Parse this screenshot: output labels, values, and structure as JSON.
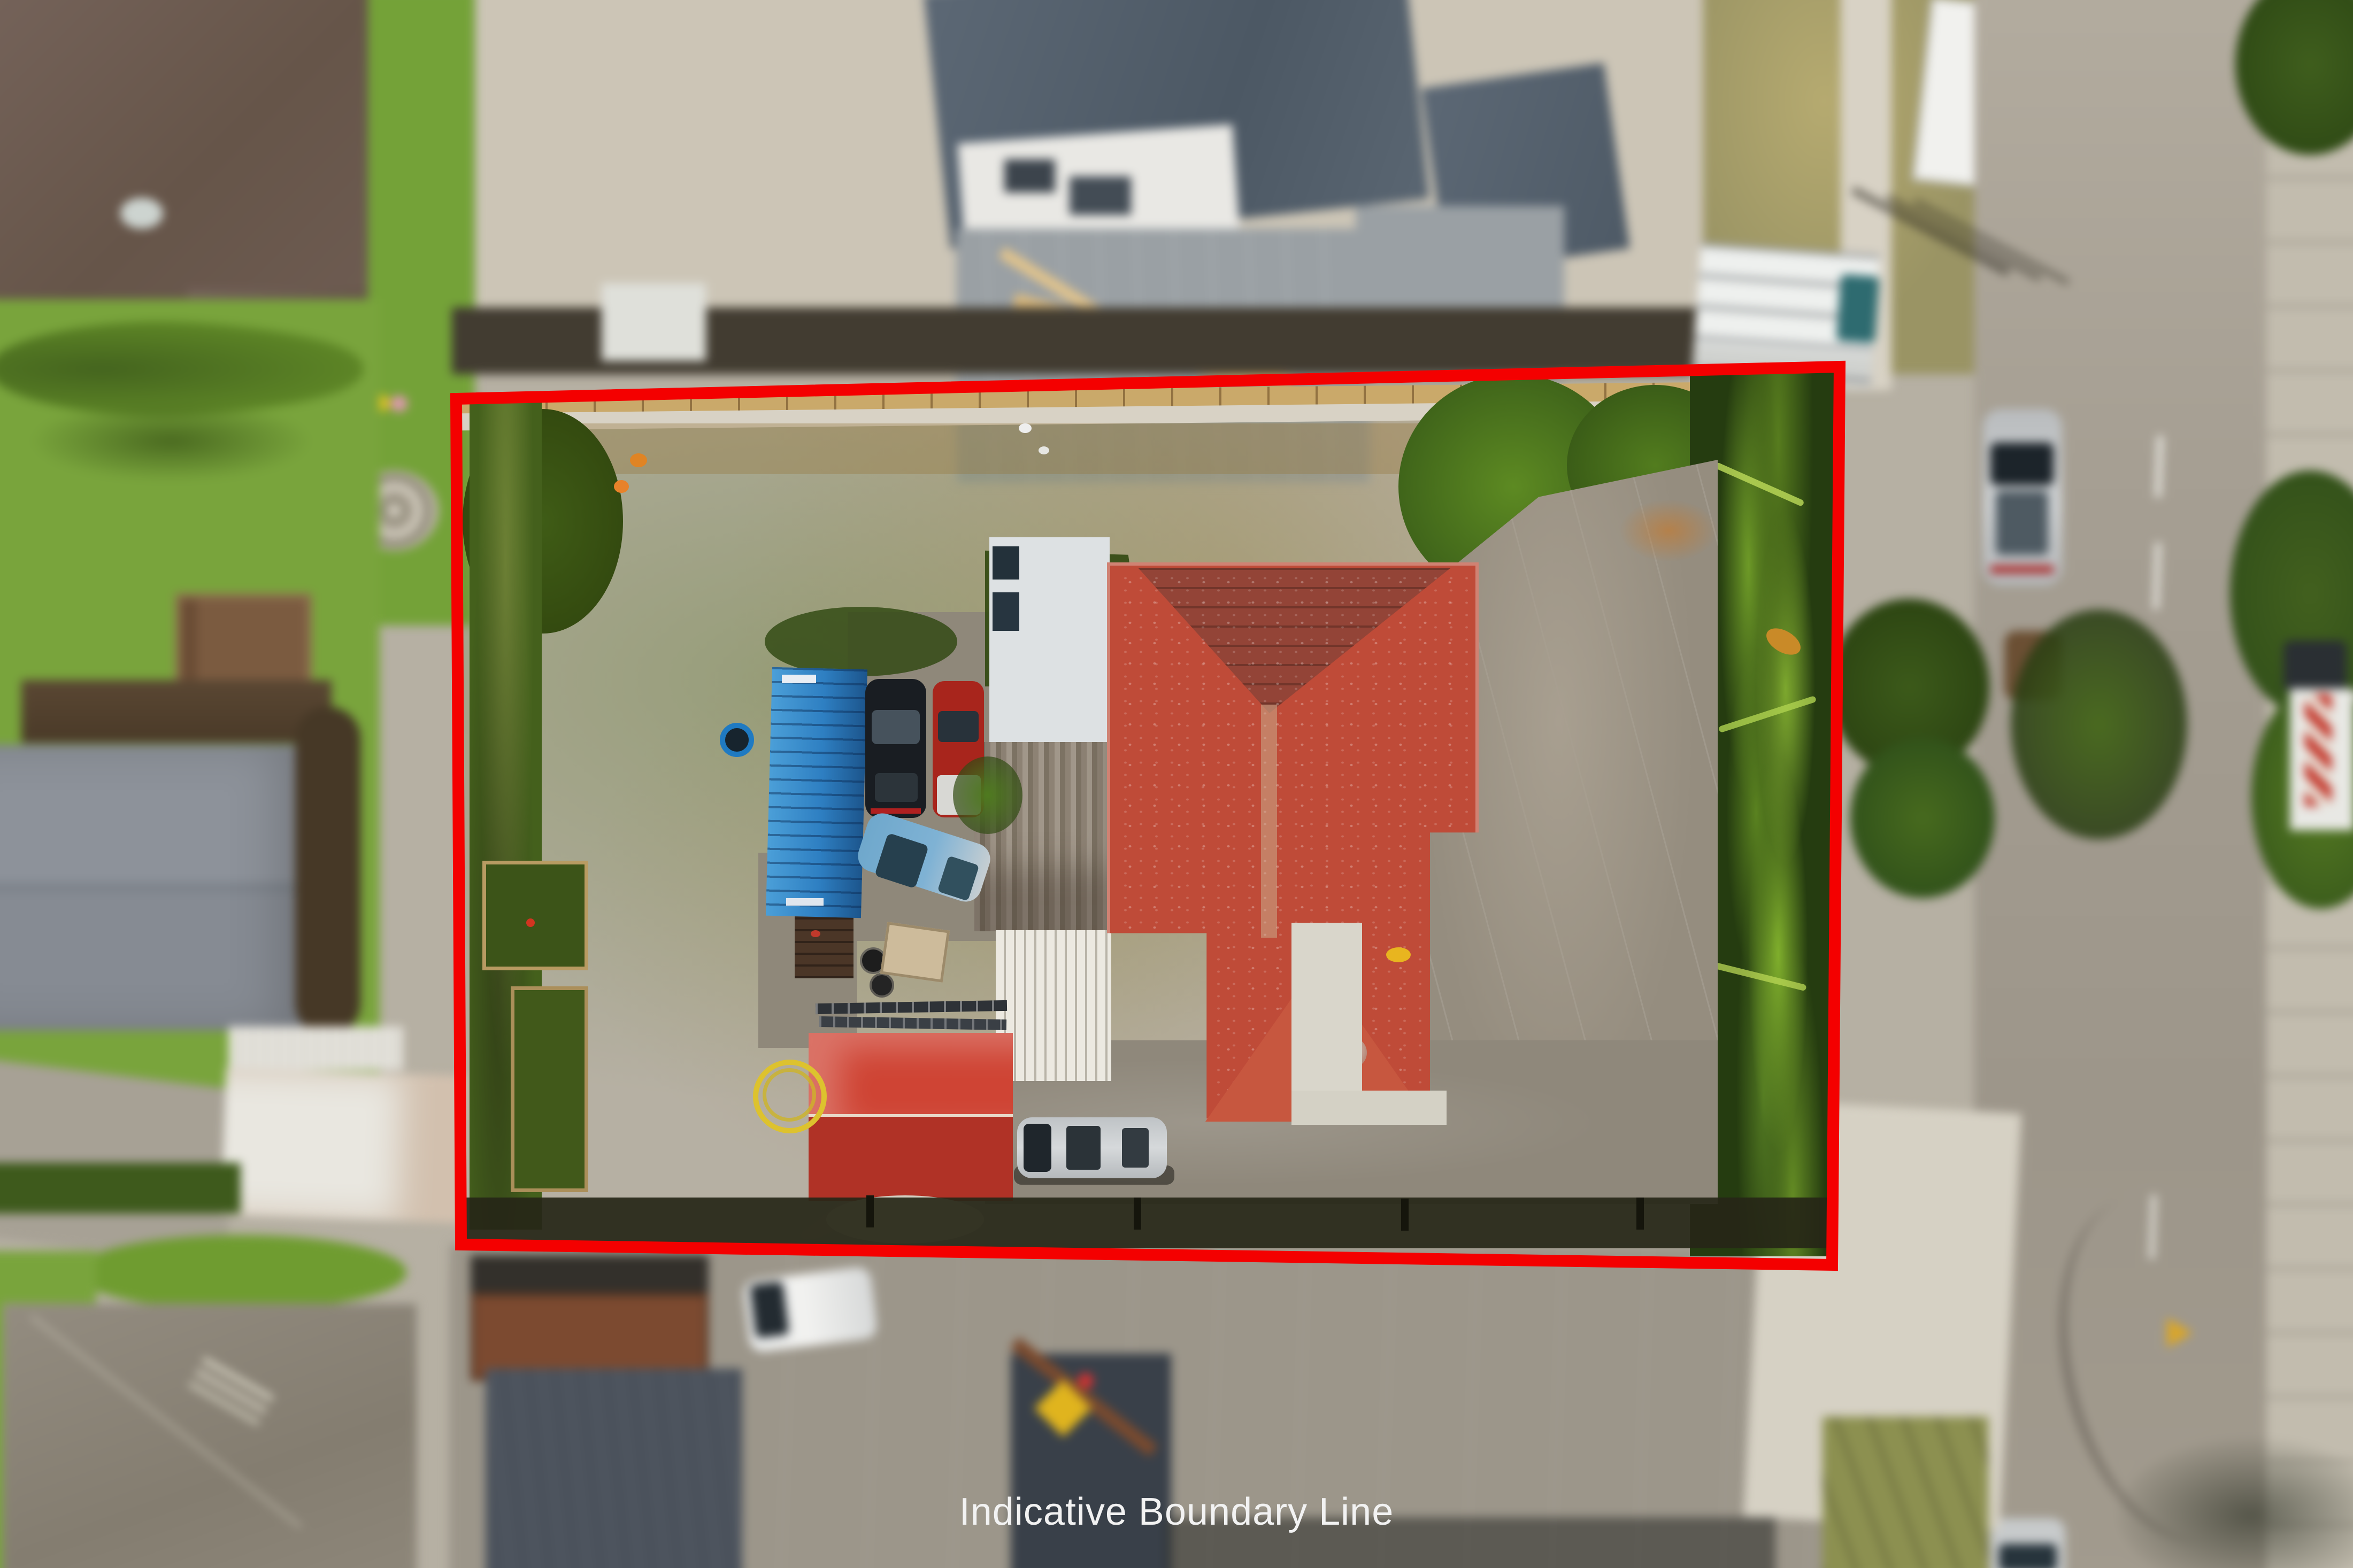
{
  "overlay": {
    "boundary_label": "Indicative Boundary Line",
    "boundary_color": "#f40000",
    "label_color": "#f2f2f2"
  },
  "palette": {
    "lawn_green": "#8aa43a",
    "hedge_dark_green": "#3f5c16",
    "driveway_concrete": "#958d7f",
    "house_roof_red": "#bf4b38",
    "shed_red": "#c43a2a",
    "container_blue": "#2e7fc2",
    "road_asphalt": "#a69f93",
    "construction_roof_gray": "#5c6875",
    "neighbor_roof_brown": "#6e5c52"
  },
  "scene_objects": [
    "red-boundary-rectangle",
    "main-house-red-tile-roof",
    "garage-white-corrugated-roof",
    "weathered-corrugated-roof",
    "carport-slat-roof",
    "red-corrugated-shed",
    "blue-shipping-container",
    "blue-trampoline",
    "yellow-garden-hose-coil",
    "black-suv",
    "red-car",
    "blue-hatchback",
    "silver-van",
    "picnic-table",
    "raised-garden-beds",
    "palm-garden-row",
    "concrete-parking-area",
    "street-with-parked-cars",
    "construction-site",
    "neighbour-roofs"
  ]
}
